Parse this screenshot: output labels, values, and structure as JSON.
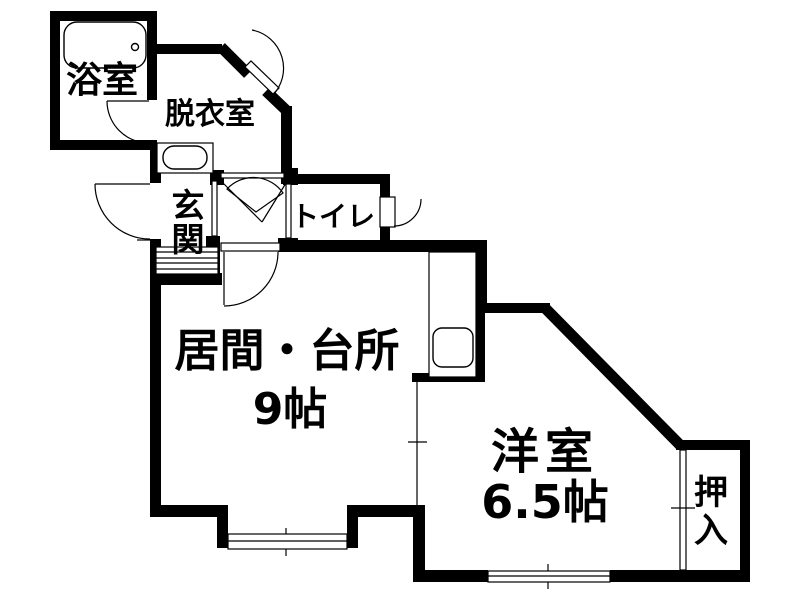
{
  "plan": {
    "type": "japanese-apartment-floor-plan",
    "colors": {
      "wall": "#000000",
      "background": "#ffffff",
      "line": "#000000"
    },
    "rooms": {
      "bathroom": {
        "label": "浴室"
      },
      "dressing_room": {
        "label": "脱衣室"
      },
      "entrance": {
        "label": "玄関",
        "chars": [
          "玄",
          "関"
        ]
      },
      "toilet": {
        "label": "トイレ"
      },
      "living_kitchen": {
        "label": "居間・台所",
        "area": "9帖"
      },
      "western_room": {
        "label": "洋室",
        "area": "6.5帖"
      },
      "closet": {
        "label": "押入",
        "chars": [
          "押",
          "入"
        ]
      }
    },
    "fixtures": {
      "bathtub": "bathtub-icon",
      "washbasin": "washbasin-icon",
      "kitchen_sink": "kitchen-sink-icon",
      "entrance_steps": "entrance-steps-icon",
      "windows": [
        "bay-window",
        "south-window"
      ],
      "doors": [
        "bath-door",
        "front-door",
        "porch-door",
        "toilet-door",
        "hall-living-door"
      ]
    }
  }
}
